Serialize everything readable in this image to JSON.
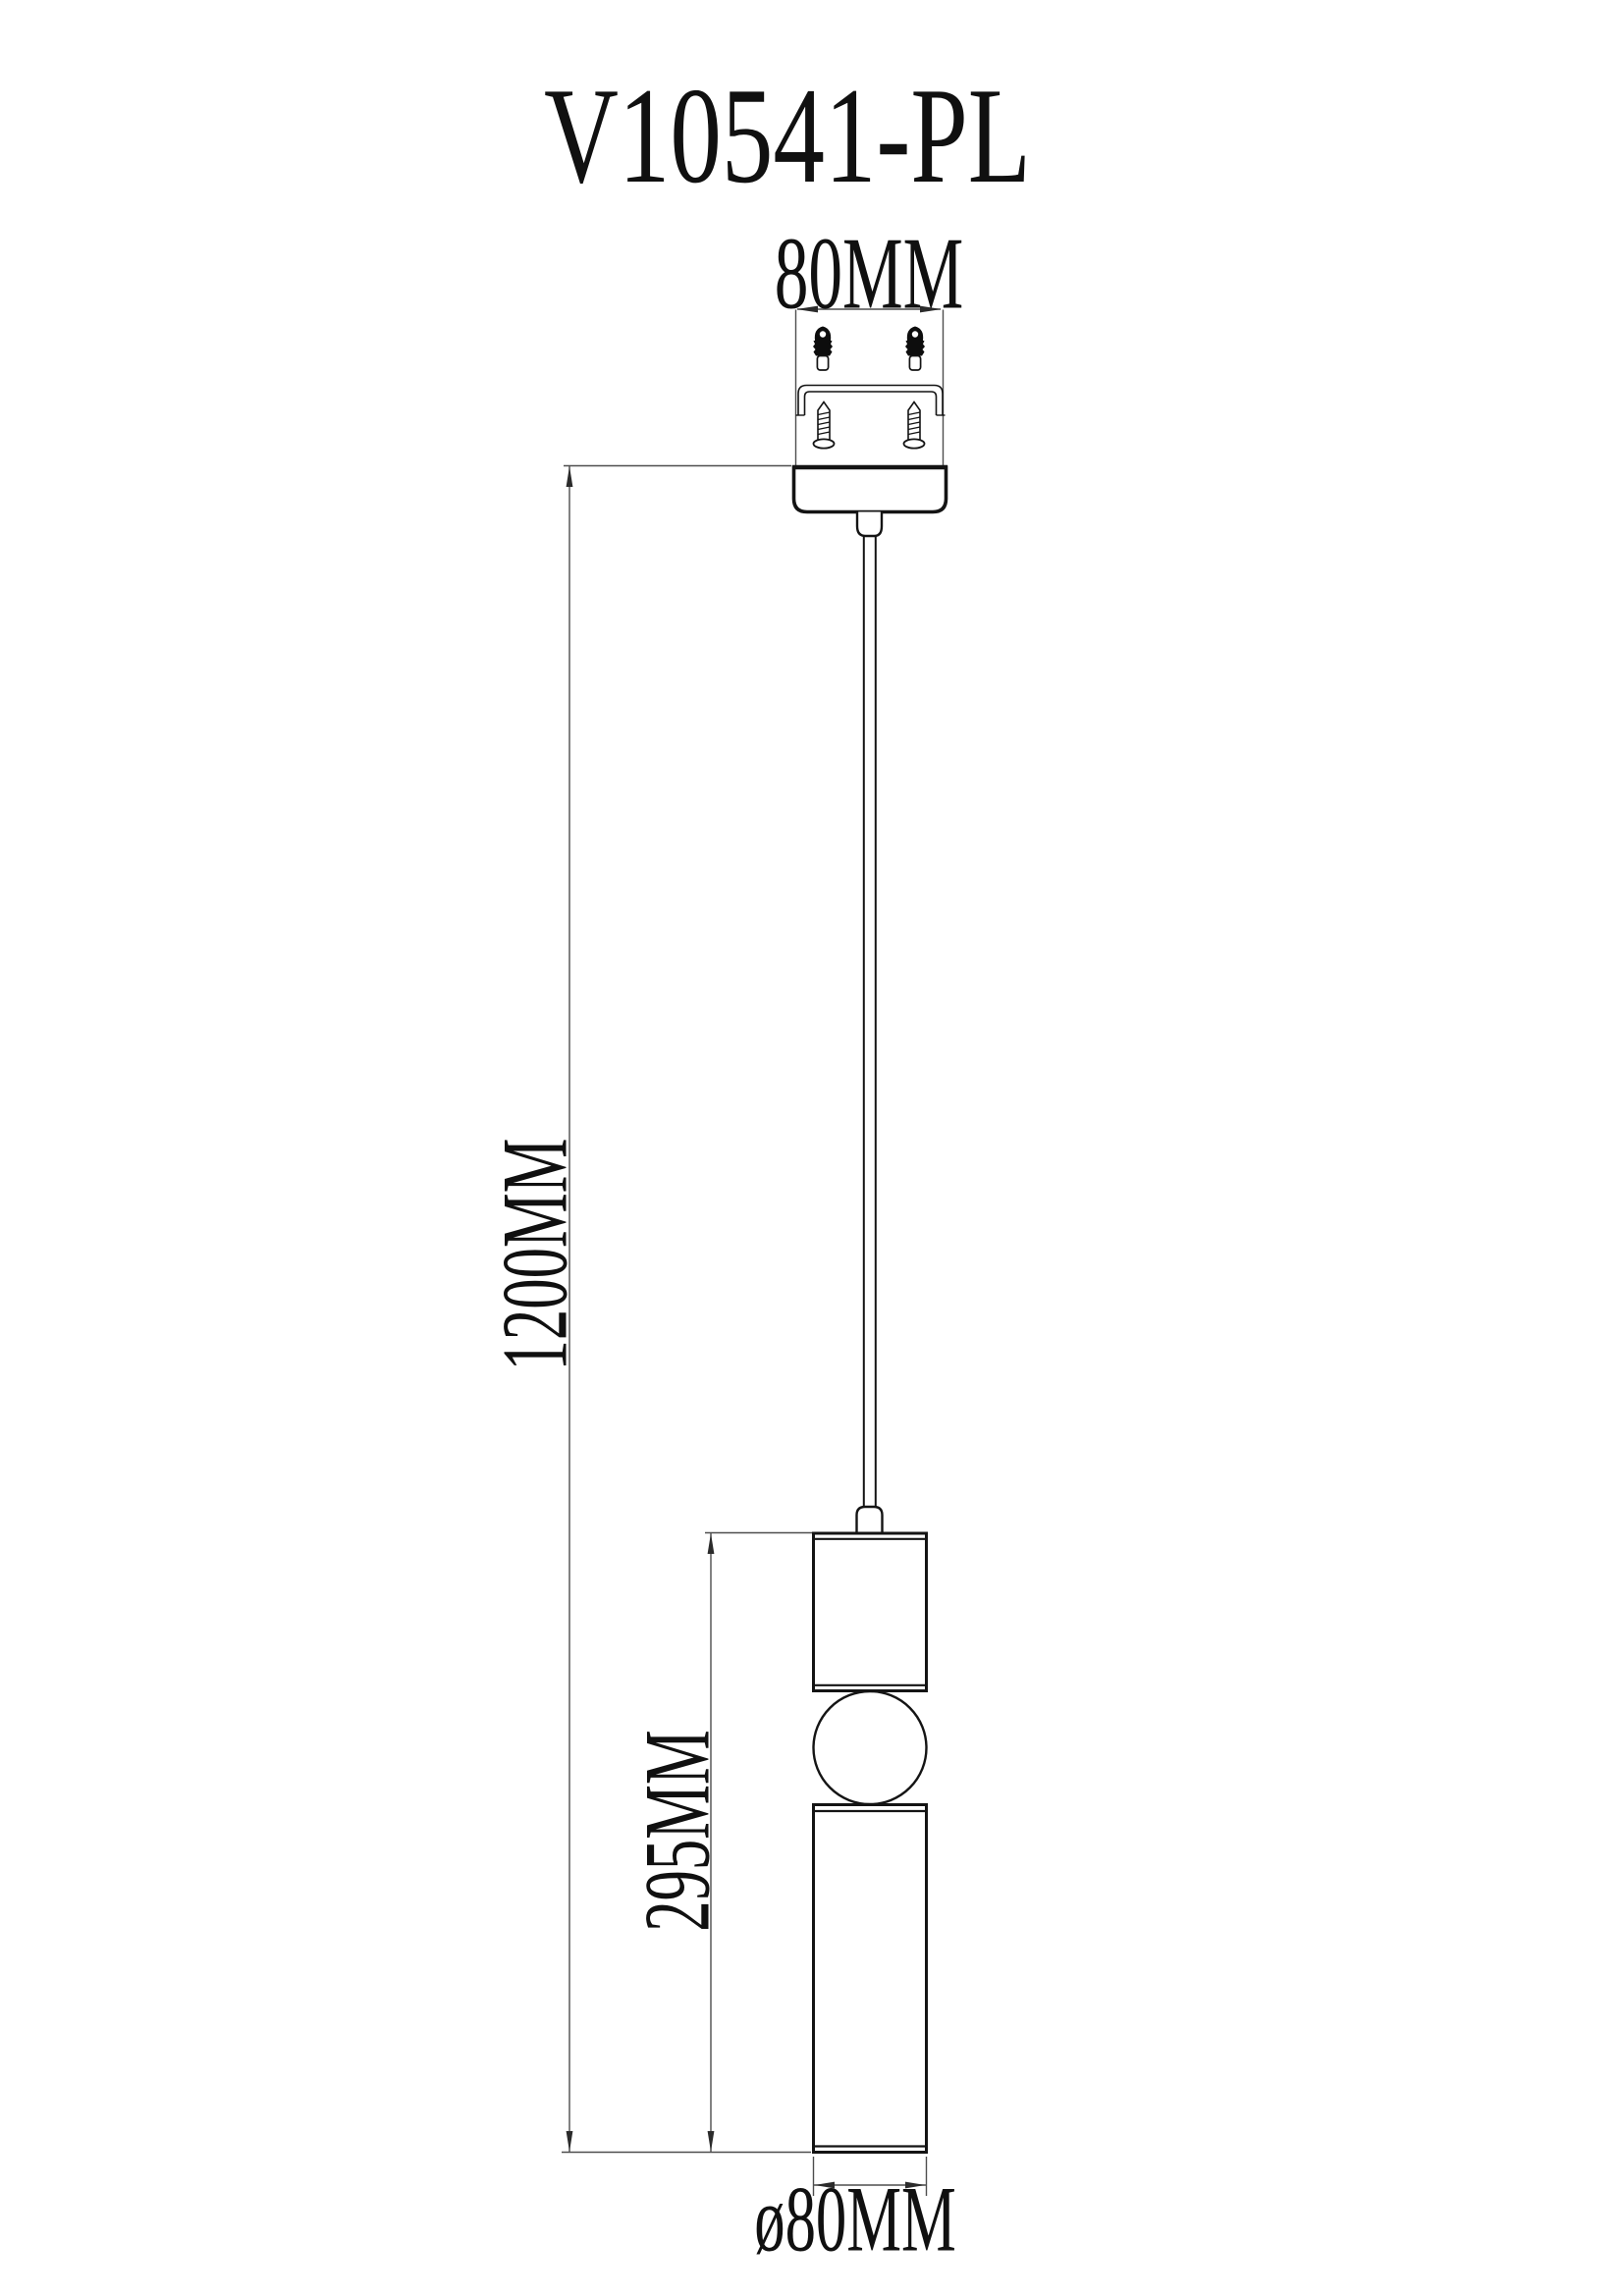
{
  "title": "V10541-PL",
  "dimensions": {
    "canopy_width": "80MM",
    "suspension_length": "1200MM",
    "fixture_height": "295MM",
    "fixture_diameter": "ø80MM"
  }
}
